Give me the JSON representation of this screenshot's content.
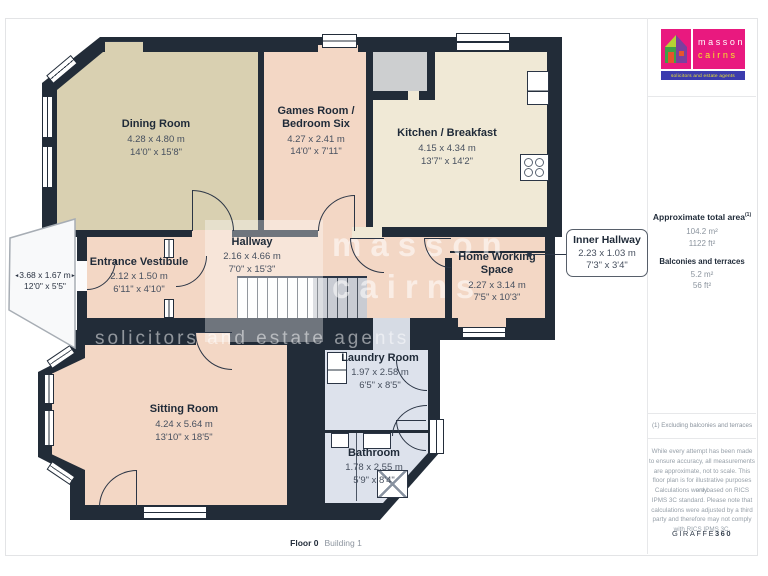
{
  "plan": {
    "rooms": {
      "dining": {
        "name": "Dining Room",
        "metric": "4.28 x 4.80 m",
        "imperial": "14'0\" x 15'8\""
      },
      "games": {
        "name": "Games Room / Bedroom Six",
        "metric": "4.27 x 2.41 m",
        "imperial": "14'0\" x 7'11\""
      },
      "kitchen": {
        "name": "Kitchen / Breakfast",
        "metric": "4.15 x 4.34 m",
        "imperial": "13'7\" x 14'2\""
      },
      "hallway": {
        "name": "Hallway",
        "metric": "2.16 x 4.66 m",
        "imperial": "7'0\" x 15'3\""
      },
      "vestibule": {
        "name": "Entrance Vestibule",
        "metric": "2.12 x 1.50 m",
        "imperial": "6'11\" x 4'10\""
      },
      "hws": {
        "name": "Home Working Space",
        "metric": "2.27 x 3.14 m",
        "imperial": "7'5\" x 10'3\""
      },
      "inner": {
        "name": "Inner Hallway",
        "metric": "2.23 x 1.03 m",
        "imperial": "7'3\" x 3'4\""
      },
      "sitting": {
        "name": "Sitting Room",
        "metric": "4.24 x 5.64 m",
        "imperial": "13'10\" x 18'5\""
      },
      "laundry": {
        "name": "Laundry Room",
        "metric": "1.97 x 2.58 m",
        "imperial": "6'5\" x 8'5\""
      },
      "bathroom": {
        "name": "Bathroom",
        "metric": "1.78 x 2.55 m",
        "imperial": "5'9\" x 8'4\""
      },
      "balcony": {
        "metric": "3.68 x 1.67 m",
        "imperial": "12'0\" x 5'5\""
      }
    },
    "watermark": {
      "line1": "masson",
      "line2": "cairns",
      "line3": "solicitors and estate agents"
    },
    "footer": {
      "floor": "Floor 0",
      "building": "Building 1"
    }
  },
  "sidebar": {
    "logo": {
      "name_line1": "masson",
      "name_line2": "cairns",
      "tagline": "solicitors and estate agents"
    },
    "areas": {
      "total_label": "Approximate total area",
      "total_sup": "(1)",
      "total_metric": "104.2 m²",
      "total_imperial": "1122 ft²",
      "balcony_label": "Balconies and terraces",
      "balcony_metric": "5.2 m²",
      "balcony_imperial": "56 ft²"
    },
    "footnote": "(1) Excluding balconies and terraces",
    "disclaimer_1": "While every attempt has been made to ensure accuracy, all measurements are approximate, not to scale. This floor plan is for illustrative purposes only.",
    "disclaimer_2": "Calculations were based on RICS IPMS 3C standard. Please note that calculations were adjusted by a third party and therefore may not comply with RICS IPMS 3C.",
    "credit_name": "GIRAFFE",
    "credit_suffix": "360"
  },
  "decor": {
    "arrow_left": "◄",
    "arrow_right": "►"
  },
  "colors": {
    "wall": "#222c38",
    "dining_floor": "#d9d0b1",
    "pink_floor": "#f3d7c5",
    "kitchen_floor": "#f0e9d6",
    "wet_floor": "#dde2ec",
    "brand_magenta": "#e9197f",
    "brand_blue": "#3c3cae",
    "brand_yellow": "#f4e926"
  }
}
